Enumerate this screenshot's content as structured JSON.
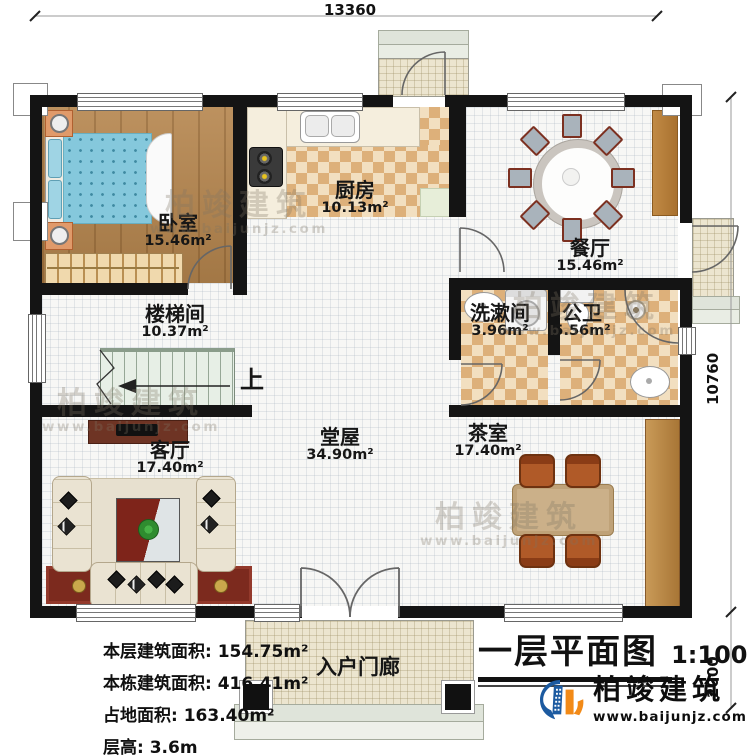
{
  "dimensions": {
    "width_top": "13360",
    "height_right_upper": "10760",
    "height_right_lower": "2000"
  },
  "rooms": {
    "bedroom": {
      "label": "卧室",
      "area": "15.46m²"
    },
    "kitchen": {
      "label": "厨房",
      "area": "10.13m²"
    },
    "dining": {
      "label": "餐厅",
      "area": "15.46m²"
    },
    "stairwell": {
      "label": "楼梯间",
      "area": "10.37m²"
    },
    "washroom": {
      "label": "洗漱间",
      "area": "3.96m²"
    },
    "bathroom": {
      "label": "公卫",
      "area": "5.56m²"
    },
    "living_room": {
      "label": "客厅",
      "area": "17.40m²"
    },
    "hall": {
      "label": "堂屋",
      "area": "34.90m²"
    },
    "tea_room": {
      "label": "茶室",
      "area": "17.40m²"
    },
    "entry_porch": {
      "label": "入户门廊"
    }
  },
  "stairs": {
    "direction_label": "上"
  },
  "info_block": {
    "lines": [
      "本层建筑面积: 154.75m²",
      "本栋建筑面积: 416.41m²",
      "占地面积: 163.40m²",
      "层高: 3.6m"
    ]
  },
  "title_block": {
    "title": "一层平面图",
    "scale": "1:100"
  },
  "branding": {
    "company": "柏竣建筑",
    "website": "www.baijunjz.com"
  },
  "watermark": {
    "company": "柏竣建筑",
    "website": "www.baijunjz.com"
  },
  "colors": {
    "wall": "#141414",
    "logo_blue": "#1c5aa0",
    "logo_orange": "#f28a17",
    "wood_floor": "#b5854d",
    "checker_tile": "#ddb07a",
    "bed_blue": "#85c8dc"
  }
}
